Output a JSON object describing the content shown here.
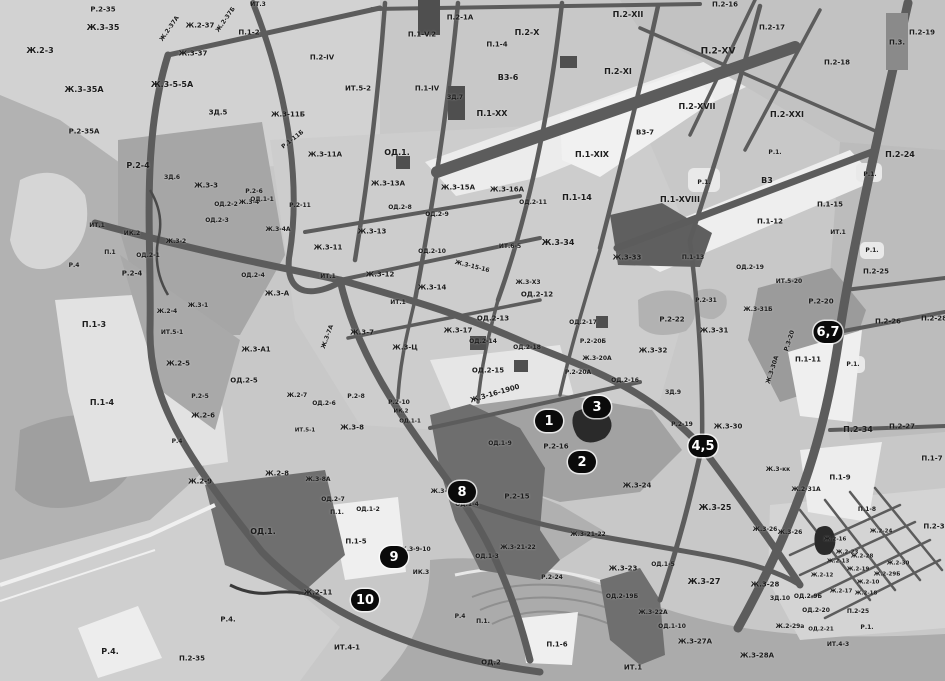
{
  "map": {
    "colors": {
      "base": "#c8c8c8",
      "road": "#5c5c5c",
      "dark_zone": "#6f6f6f",
      "white_zone": "#ededed",
      "river": "#ababab",
      "marker_bg": "#0a0a0a",
      "marker_text": "#ffffff",
      "label_text": "#1c1c1c"
    },
    "markers": [
      {
        "n": "1",
        "x": 549,
        "y": 421
      },
      {
        "n": "2",
        "x": 582,
        "y": 462
      },
      {
        "n": "3",
        "x": 597,
        "y": 407
      },
      {
        "n": "4,5",
        "x": 703,
        "y": 446
      },
      {
        "n": "6,7",
        "x": 828,
        "y": 332
      },
      {
        "n": "8",
        "x": 462,
        "y": 492
      },
      {
        "n": "9",
        "x": 394,
        "y": 557
      },
      {
        "n": "10",
        "x": 365,
        "y": 600
      }
    ],
    "labels": [
      {
        "t": "Р.2-35",
        "x": 103,
        "y": 10
      },
      {
        "t": "Ж.3-35",
        "x": 103,
        "y": 28,
        "s": 8
      },
      {
        "t": "Ж.2-37",
        "x": 200,
        "y": 26
      },
      {
        "t": "Ж.2-37А",
        "x": 170,
        "y": 29,
        "r": -55,
        "s": 6
      },
      {
        "t": "Ж.2-37Б",
        "x": 226,
        "y": 20,
        "r": -55,
        "s": 6
      },
      {
        "t": "Ж.3-37",
        "x": 193,
        "y": 54
      },
      {
        "t": "П.1-2",
        "x": 249,
        "y": 33
      },
      {
        "t": "ИТ.3",
        "x": 258,
        "y": 5,
        "s": 6
      },
      {
        "t": "Ж.2-3",
        "x": 40,
        "y": 51,
        "s": 8
      },
      {
        "t": "Ж.3-35А",
        "x": 84,
        "y": 90,
        "s": 8
      },
      {
        "t": "Ж.3-5-5А",
        "x": 172,
        "y": 85,
        "s": 8
      },
      {
        "t": "Р.2-35А",
        "x": 84,
        "y": 132
      },
      {
        "t": "ЗД.5",
        "x": 218,
        "y": 113
      },
      {
        "t": "Ж.3-11Б",
        "x": 288,
        "y": 115
      },
      {
        "t": "Р.1-11Б",
        "x": 293,
        "y": 140,
        "r": -38,
        "s": 6
      },
      {
        "t": "Ж.3-11А",
        "x": 325,
        "y": 155
      },
      {
        "t": "Р.2-4",
        "x": 138,
        "y": 166,
        "s": 8
      },
      {
        "t": "ЗД.6",
        "x": 172,
        "y": 178,
        "s": 6
      },
      {
        "t": "Ж.3-3",
        "x": 206,
        "y": 186
      },
      {
        "t": "Р.2-6",
        "x": 254,
        "y": 192,
        "s": 6
      },
      {
        "t": "ОД.1-1",
        "x": 262,
        "y": 200,
        "s": 6
      },
      {
        "t": "Р.2-11",
        "x": 300,
        "y": 206,
        "s": 6
      },
      {
        "t": "ОД.2-2",
        "x": 226,
        "y": 205,
        "s": 6
      },
      {
        "t": "ОД.2-3",
        "x": 217,
        "y": 221,
        "s": 6
      },
      {
        "t": "Ж.3-4",
        "x": 249,
        "y": 203,
        "s": 6
      },
      {
        "t": "Ж.3-4А",
        "x": 278,
        "y": 230,
        "s": 6
      },
      {
        "t": "ИТ.1",
        "x": 97,
        "y": 226,
        "s": 6
      },
      {
        "t": "ИК.2",
        "x": 132,
        "y": 234,
        "s": 6
      },
      {
        "t": "П.1",
        "x": 110,
        "y": 253,
        "s": 6
      },
      {
        "t": "Ж.3-2",
        "x": 176,
        "y": 242,
        "s": 6
      },
      {
        "t": "ОД.2-1",
        "x": 148,
        "y": 256,
        "s": 6
      },
      {
        "t": "Ж.3-1",
        "x": 198,
        "y": 306,
        "s": 6
      },
      {
        "t": "Р.2-4",
        "x": 132,
        "y": 274
      },
      {
        "t": "Р.4",
        "x": 74,
        "y": 266,
        "s": 6
      },
      {
        "t": "Ж.2-4",
        "x": 167,
        "y": 312,
        "s": 6
      },
      {
        "t": "ИТ.5-1",
        "x": 172,
        "y": 333,
        "s": 6
      },
      {
        "t": "ОД.2-4",
        "x": 253,
        "y": 276,
        "s": 6
      },
      {
        "t": "Ж.3-А",
        "x": 277,
        "y": 294
      },
      {
        "t": "Ж.3-А1",
        "x": 256,
        "y": 350
      },
      {
        "t": "П.1-3",
        "x": 94,
        "y": 325,
        "s": 8
      },
      {
        "t": "Ж.2-5",
        "x": 178,
        "y": 364
      },
      {
        "t": "ОД.2-5",
        "x": 244,
        "y": 381
      },
      {
        "t": "Р.2-5",
        "x": 200,
        "y": 397,
        "s": 6
      },
      {
        "t": "Ж.2-6",
        "x": 203,
        "y": 416
      },
      {
        "t": "П.1-4",
        "x": 102,
        "y": 403,
        "s": 8
      },
      {
        "t": "Р.4",
        "x": 177,
        "y": 442,
        "s": 6
      },
      {
        "t": "Ж.2-9",
        "x": 200,
        "y": 482
      },
      {
        "t": "Ж.2-8",
        "x": 277,
        "y": 474
      },
      {
        "t": "Ж.2-7",
        "x": 297,
        "y": 396,
        "s": 6
      },
      {
        "t": "ОД.1.",
        "x": 263,
        "y": 532,
        "s": 8
      },
      {
        "t": "Ж.2-11",
        "x": 318,
        "y": 593
      },
      {
        "t": "Р.4.",
        "x": 228,
        "y": 620
      },
      {
        "t": "П.2-35",
        "x": 192,
        "y": 659
      },
      {
        "t": "Р.4.",
        "x": 110,
        "y": 652,
        "s": 8
      },
      {
        "t": "ИТ.4-1",
        "x": 347,
        "y": 648
      },
      {
        "t": "ИК.3",
        "x": 421,
        "y": 573,
        "s": 6
      },
      {
        "t": "Ж.3-9-10",
        "x": 415,
        "y": 550,
        "s": 6
      },
      {
        "t": "П.1-5",
        "x": 356,
        "y": 542
      },
      {
        "t": "ОД.2-6",
        "x": 324,
        "y": 404,
        "s": 6
      },
      {
        "t": "Р.2-8",
        "x": 356,
        "y": 397,
        "s": 6
      },
      {
        "t": "Р.2-10",
        "x": 399,
        "y": 403,
        "s": 6
      },
      {
        "t": "ИК.2",
        "x": 401,
        "y": 412,
        "s": 5.5
      },
      {
        "t": "ОД.1-1",
        "x": 410,
        "y": 422,
        "s": 5.5
      },
      {
        "t": "Ж.3-8",
        "x": 352,
        "y": 428
      },
      {
        "t": "ИТ.5-1",
        "x": 305,
        "y": 431,
        "s": 5.5
      },
      {
        "t": "Ж.3-8А",
        "x": 318,
        "y": 480,
        "s": 6
      },
      {
        "t": "ОД.2-7",
        "x": 333,
        "y": 500,
        "s": 6
      },
      {
        "t": "П.1.",
        "x": 337,
        "y": 513,
        "s": 6
      },
      {
        "t": "ОД.1-2",
        "x": 368,
        "y": 510,
        "s": 6
      },
      {
        "t": "Ж.3-18",
        "x": 443,
        "y": 492,
        "s": 6
      },
      {
        "t": "ОД.1-4",
        "x": 467,
        "y": 505,
        "s": 6
      },
      {
        "t": "ОД.1-9",
        "x": 500,
        "y": 444,
        "s": 6
      },
      {
        "t": "ОД.1-3",
        "x": 487,
        "y": 557,
        "s": 6
      },
      {
        "t": "Р.2-16",
        "x": 556,
        "y": 447
      },
      {
        "t": "Р.2-15",
        "x": 517,
        "y": 497
      },
      {
        "t": "Ж.3-21-22",
        "x": 518,
        "y": 548,
        "s": 6
      },
      {
        "t": "Ж.3-21-22",
        "x": 588,
        "y": 535,
        "s": 6
      },
      {
        "t": "Р.2-24",
        "x": 552,
        "y": 578,
        "s": 6
      },
      {
        "t": "ОД.2-19Б",
        "x": 622,
        "y": 597,
        "s": 6
      },
      {
        "t": "Ж.3-23",
        "x": 623,
        "y": 569
      },
      {
        "t": "ОД.1-5",
        "x": 663,
        "y": 565,
        "s": 6
      },
      {
        "t": "Ж.3-22А",
        "x": 653,
        "y": 613,
        "s": 6
      },
      {
        "t": "ОД.1-10",
        "x": 672,
        "y": 627,
        "s": 6
      },
      {
        "t": "Ж.3-27",
        "x": 704,
        "y": 582,
        "s": 8
      },
      {
        "t": "Ж.3-28",
        "x": 765,
        "y": 585
      },
      {
        "t": "Ж.3-27А",
        "x": 695,
        "y": 642
      },
      {
        "t": "Ж.3-28А",
        "x": 757,
        "y": 656
      },
      {
        "t": "ЗД.10",
        "x": 780,
        "y": 599,
        "s": 6
      },
      {
        "t": "ОД.2-9Б",
        "x": 808,
        "y": 597,
        "s": 6
      },
      {
        "t": "ОД.2-20",
        "x": 816,
        "y": 611,
        "s": 6
      },
      {
        "t": "Ж.2-29а",
        "x": 790,
        "y": 627,
        "s": 6
      },
      {
        "t": "ОД.2-21",
        "x": 821,
        "y": 630,
        "s": 5.5
      },
      {
        "t": "П.2-25",
        "x": 858,
        "y": 612,
        "s": 6
      },
      {
        "t": "ИТ.4-3",
        "x": 838,
        "y": 645,
        "s": 6
      },
      {
        "t": "Р.1.",
        "x": 867,
        "y": 628,
        "s": 6
      },
      {
        "t": "ОД.2",
        "x": 491,
        "y": 663
      },
      {
        "t": "П.1-6",
        "x": 557,
        "y": 645
      },
      {
        "t": "П.1.",
        "x": 483,
        "y": 622,
        "s": 6
      },
      {
        "t": "Р.4",
        "x": 460,
        "y": 617,
        "s": 6
      },
      {
        "t": "ИТ.1",
        "x": 633,
        "y": 668
      },
      {
        "t": "Ж.3-16-1900",
        "x": 495,
        "y": 394,
        "r": -16
      },
      {
        "t": "Ж.3-24",
        "x": 637,
        "y": 486
      },
      {
        "t": "Ж.3-25",
        "x": 715,
        "y": 508,
        "s": 8
      },
      {
        "t": "Ж.3-26",
        "x": 765,
        "y": 530,
        "s": 6
      },
      {
        "t": "Ж.3-26",
        "x": 790,
        "y": 533,
        "s": 6
      },
      {
        "t": "Ж.3-30",
        "x": 728,
        "y": 427
      },
      {
        "t": "Р.2-19",
        "x": 682,
        "y": 425,
        "s": 6
      },
      {
        "t": "ЗД.9",
        "x": 673,
        "y": 393,
        "s": 6
      },
      {
        "t": "Ж.2-31А",
        "x": 806,
        "y": 490,
        "s": 6
      },
      {
        "t": "Ж.3-кк",
        "x": 778,
        "y": 470,
        "s": 6
      },
      {
        "t": "П.1-9",
        "x": 840,
        "y": 478
      },
      {
        "t": "П.1-8",
        "x": 867,
        "y": 510,
        "s": 6
      },
      {
        "t": "П.2-34",
        "x": 858,
        "y": 430,
        "s": 8
      },
      {
        "t": "П.2-27",
        "x": 902,
        "y": 427
      },
      {
        "t": "П.1-7",
        "x": 932,
        "y": 459
      },
      {
        "t": "П.2-3",
        "x": 934,
        "y": 527
      },
      {
        "t": "Ж.2-24",
        "x": 881,
        "y": 532,
        "s": 5.5
      },
      {
        "t": "Ж.2-16",
        "x": 835,
        "y": 540,
        "s": 5.5
      },
      {
        "t": "Ж.2-23",
        "x": 847,
        "y": 553,
        "s": 5.5
      },
      {
        "t": "Ж.2-28",
        "x": 862,
        "y": 557,
        "s": 5.5
      },
      {
        "t": "Ж.2-13",
        "x": 838,
        "y": 562,
        "s": 5.5
      },
      {
        "t": "Ж.2-30",
        "x": 898,
        "y": 564,
        "s": 5.5
      },
      {
        "t": "Ж.2-12",
        "x": 822,
        "y": 576,
        "s": 5.5
      },
      {
        "t": "Ж.2-19",
        "x": 858,
        "y": 570,
        "s": 5.5
      },
      {
        "t": "Ж.2-29Б",
        "x": 887,
        "y": 575,
        "s": 5.5
      },
      {
        "t": "Ж.2-10",
        "x": 868,
        "y": 583,
        "s": 5.5
      },
      {
        "t": "Ж.2-17",
        "x": 841,
        "y": 592,
        "s": 5.5
      },
      {
        "t": "Ж.2-18",
        "x": 866,
        "y": 594,
        "s": 5.5
      },
      {
        "t": "П.2-26",
        "x": 888,
        "y": 322
      },
      {
        "t": "П.2-28",
        "x": 934,
        "y": 319
      },
      {
        "t": "П.2-25",
        "x": 876,
        "y": 272
      },
      {
        "t": "Р.1.",
        "x": 872,
        "y": 251,
        "s": 6
      },
      {
        "t": "Р.1.",
        "x": 853,
        "y": 365,
        "s": 6
      },
      {
        "t": "ИТ.1",
        "x": 838,
        "y": 233,
        "s": 6
      },
      {
        "t": "П.1-11",
        "x": 808,
        "y": 360
      },
      {
        "t": "Р.2-20",
        "x": 821,
        "y": 302
      },
      {
        "t": "Ж.3-31Б",
        "x": 758,
        "y": 310,
        "s": 6
      },
      {
        "t": "Р.2-31",
        "x": 706,
        "y": 301,
        "s": 6
      },
      {
        "t": "Р.2-22",
        "x": 672,
        "y": 320
      },
      {
        "t": "Ж.3-31",
        "x": 714,
        "y": 331
      },
      {
        "t": "Ж.3-32",
        "x": 653,
        "y": 351
      },
      {
        "t": "Р.3-20",
        "x": 790,
        "y": 341,
        "r": -72,
        "s": 6
      },
      {
        "t": "Ж.3-30А",
        "x": 773,
        "y": 370,
        "r": -72,
        "s": 6
      },
      {
        "t": "ОД.2-19",
        "x": 750,
        "y": 268,
        "s": 6
      },
      {
        "t": "ИТ.5-20",
        "x": 789,
        "y": 282,
        "s": 6
      },
      {
        "t": "П.1-13",
        "x": 693,
        "y": 258,
        "s": 6
      },
      {
        "t": "П.1-12",
        "x": 770,
        "y": 222
      },
      {
        "t": "П.1-15",
        "x": 830,
        "y": 205
      },
      {
        "t": "В3",
        "x": 767,
        "y": 181,
        "s": 8
      },
      {
        "t": "Р.1.",
        "x": 704,
        "y": 183,
        "s": 6
      },
      {
        "t": "П.1-XVIII",
        "x": 680,
        "y": 200,
        "s": 8
      },
      {
        "t": "Р.1.",
        "x": 775,
        "y": 153,
        "s": 6
      },
      {
        "t": "П.2-24",
        "x": 900,
        "y": 155,
        "s": 8
      },
      {
        "t": "Р.1.",
        "x": 870,
        "y": 175,
        "s": 6
      },
      {
        "t": "П.2-XXI",
        "x": 787,
        "y": 115,
        "s": 8
      },
      {
        "t": "П.2-XVII",
        "x": 697,
        "y": 107,
        "s": 8
      },
      {
        "t": "П.2-XV",
        "x": 718,
        "y": 52,
        "s": 9
      },
      {
        "t": "П.2-18",
        "x": 837,
        "y": 63
      },
      {
        "t": "П.3.",
        "x": 897,
        "y": 43
      },
      {
        "t": "П.2-19",
        "x": 922,
        "y": 33
      },
      {
        "t": "П.2-16",
        "x": 725,
        "y": 5
      },
      {
        "t": "П.2-17",
        "x": 772,
        "y": 28
      },
      {
        "t": "В3-7",
        "x": 645,
        "y": 133
      },
      {
        "t": "П.1-XIX",
        "x": 592,
        "y": 155,
        "s": 8
      },
      {
        "t": "П.1-14",
        "x": 577,
        "y": 198,
        "s": 8
      },
      {
        "t": "Ж.3-34",
        "x": 558,
        "y": 243,
        "s": 8
      },
      {
        "t": "Ж.3-33",
        "x": 627,
        "y": 258
      },
      {
        "t": "ОД.2-11",
        "x": 533,
        "y": 203,
        "s": 6
      },
      {
        "t": "Ж.3-16А",
        "x": 507,
        "y": 190
      },
      {
        "t": "Ж.3-15А",
        "x": 458,
        "y": 188
      },
      {
        "t": "Ж.3-13А",
        "x": 388,
        "y": 184
      },
      {
        "t": "ОД.2-8",
        "x": 400,
        "y": 208,
        "s": 6
      },
      {
        "t": "ОД.2-9",
        "x": 437,
        "y": 215,
        "s": 6
      },
      {
        "t": "ОД.1.",
        "x": 397,
        "y": 153,
        "s": 8
      },
      {
        "t": "Ж.3-13",
        "x": 372,
        "y": 232
      },
      {
        "t": "Ж.3-11",
        "x": 328,
        "y": 248
      },
      {
        "t": "ОД.2-10",
        "x": 432,
        "y": 252,
        "s": 6
      },
      {
        "t": "Ж.3-15-16",
        "x": 472,
        "y": 267,
        "r": 14,
        "s": 6
      },
      {
        "t": "ИТ.6-5",
        "x": 510,
        "y": 247,
        "s": 6
      },
      {
        "t": "Ж.3-12",
        "x": 380,
        "y": 275
      },
      {
        "t": "Ж.3-14",
        "x": 432,
        "y": 288
      },
      {
        "t": "ИТ.1",
        "x": 328,
        "y": 277,
        "s": 6
      },
      {
        "t": "ИТ.1",
        "x": 398,
        "y": 303,
        "s": 6
      },
      {
        "t": "Ж.3-Х3",
        "x": 528,
        "y": 283,
        "s": 6
      },
      {
        "t": "ОД.2-12",
        "x": 537,
        "y": 295
      },
      {
        "t": "ОД.2-13",
        "x": 493,
        "y": 319
      },
      {
        "t": "Ж.3-17",
        "x": 458,
        "y": 331
      },
      {
        "t": "Ж.3-Ц",
        "x": 405,
        "y": 348
      },
      {
        "t": "Ж.3-7",
        "x": 362,
        "y": 333
      },
      {
        "t": "Ж.3-7А",
        "x": 328,
        "y": 337,
        "r": -70,
        "s": 6
      },
      {
        "t": "ОД.2-14",
        "x": 483,
        "y": 342,
        "s": 6
      },
      {
        "t": "ОД.2-17",
        "x": 583,
        "y": 323,
        "s": 6
      },
      {
        "t": "Р.2-20Б",
        "x": 593,
        "y": 342,
        "s": 6
      },
      {
        "t": "Ж.3-20А",
        "x": 597,
        "y": 359,
        "s": 6
      },
      {
        "t": "Р.2-20А",
        "x": 578,
        "y": 373,
        "s": 6
      },
      {
        "t": "ОД.2-15",
        "x": 488,
        "y": 371
      },
      {
        "t": "ОД.2-18",
        "x": 527,
        "y": 348,
        "s": 6
      },
      {
        "t": "ОД.2-16",
        "x": 625,
        "y": 381,
        "s": 6
      },
      {
        "t": "П.2-1А",
        "x": 460,
        "y": 18
      },
      {
        "t": "П.1-V.2",
        "x": 422,
        "y": 35
      },
      {
        "t": "П.1-4",
        "x": 497,
        "y": 45
      },
      {
        "t": "П.2-X",
        "x": 527,
        "y": 33,
        "s": 8
      },
      {
        "t": "П.2-XII",
        "x": 628,
        "y": 15,
        "s": 8
      },
      {
        "t": "П.2-XI",
        "x": 618,
        "y": 72,
        "s": 8
      },
      {
        "t": "В3-6",
        "x": 508,
        "y": 78,
        "s": 8
      },
      {
        "t": "П.2-IV",
        "x": 322,
        "y": 58
      },
      {
        "t": "ИТ.5-2",
        "x": 358,
        "y": 89
      },
      {
        "t": "П.1-IV",
        "x": 427,
        "y": 89
      },
      {
        "t": "ЗД.7",
        "x": 455,
        "y": 98,
        "s": 6
      },
      {
        "t": "П.1-XX",
        "x": 492,
        "y": 114,
        "s": 8
      }
    ]
  }
}
